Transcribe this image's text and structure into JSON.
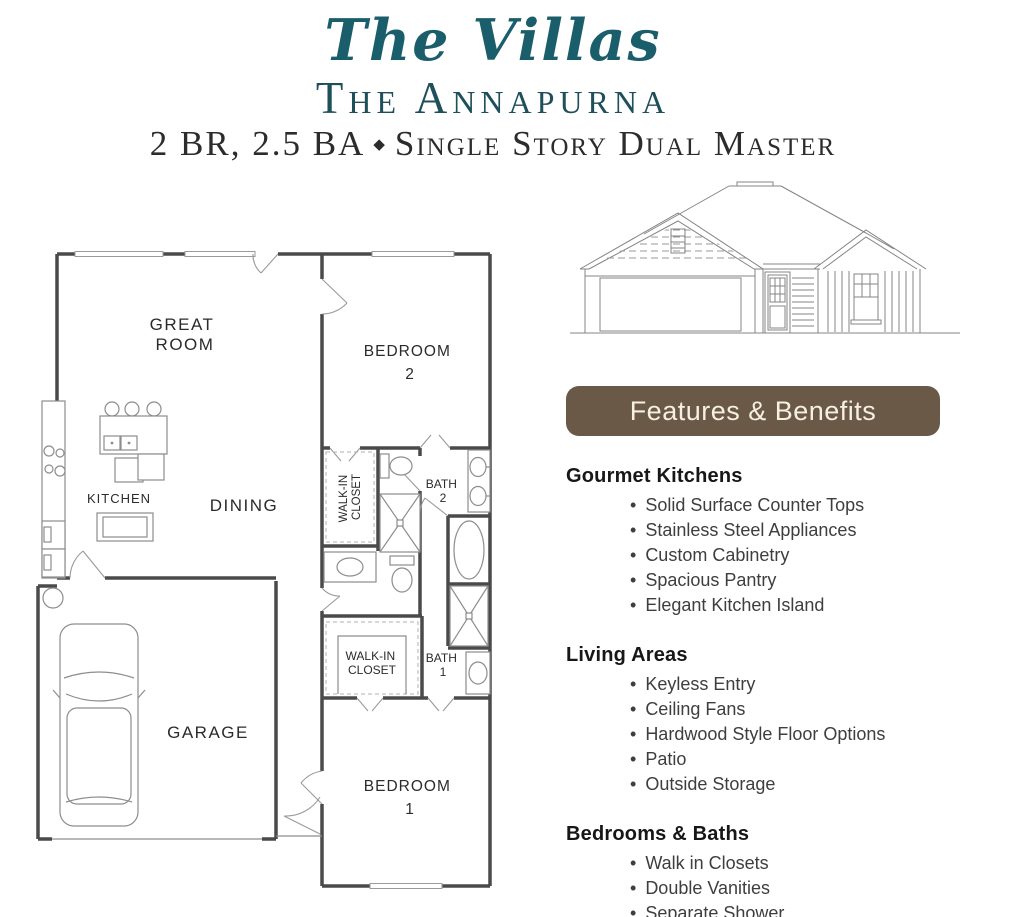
{
  "colors": {
    "teal_script": "#1b5e6b",
    "teal_serif": "#1e4f5b",
    "subtitle_text": "#2d2b2c",
    "banner_bg": "#6b5947",
    "banner_text": "#f6f0e3",
    "heading_text": "#171717",
    "item_text": "#3e3e3e"
  },
  "header": {
    "brand": "The Villas",
    "plan_name": "The Annapurna",
    "specs": "2 BR, 2.5 BA",
    "separator": "◆",
    "descriptor": "Single Story Dual Master"
  },
  "floor_plan": {
    "rooms": {
      "great_room_line1": "GREAT",
      "great_room_line2": "ROOM",
      "kitchen": "KITCHEN",
      "dining": "DINING",
      "garage": "GARAGE",
      "bedroom2_line1": "BEDROOM",
      "bedroom2_line2": "2",
      "bedroom1_line1": "BEDROOM",
      "bedroom1_line2": "1",
      "walkin2_line1": "WALK-IN",
      "walkin2_line2": "CLOSET",
      "walkin1_line1": "WALK-IN",
      "walkin1_line2": "CLOSET",
      "bath2_line1": "BATH",
      "bath2_line2": "2",
      "bath1_line1": "BATH",
      "bath1_line2": "1"
    }
  },
  "features": {
    "banner": "Features & Benefits",
    "sections": [
      {
        "title": "Gourmet Kitchens",
        "items": [
          "Solid Surface Counter Tops",
          "Stainless Steel Appliances",
          "Custom Cabinetry",
          "Spacious Pantry",
          "Elegant Kitchen Island"
        ]
      },
      {
        "title": "Living Areas",
        "items": [
          "Keyless Entry",
          "Ceiling Fans",
          "Hardwood Style Floor Options",
          "Patio",
          "Outside Storage"
        ]
      },
      {
        "title": "Bedrooms & Baths",
        "items": [
          "Walk in Closets",
          "Double Vanities",
          "Separate Shower"
        ]
      }
    ]
  }
}
